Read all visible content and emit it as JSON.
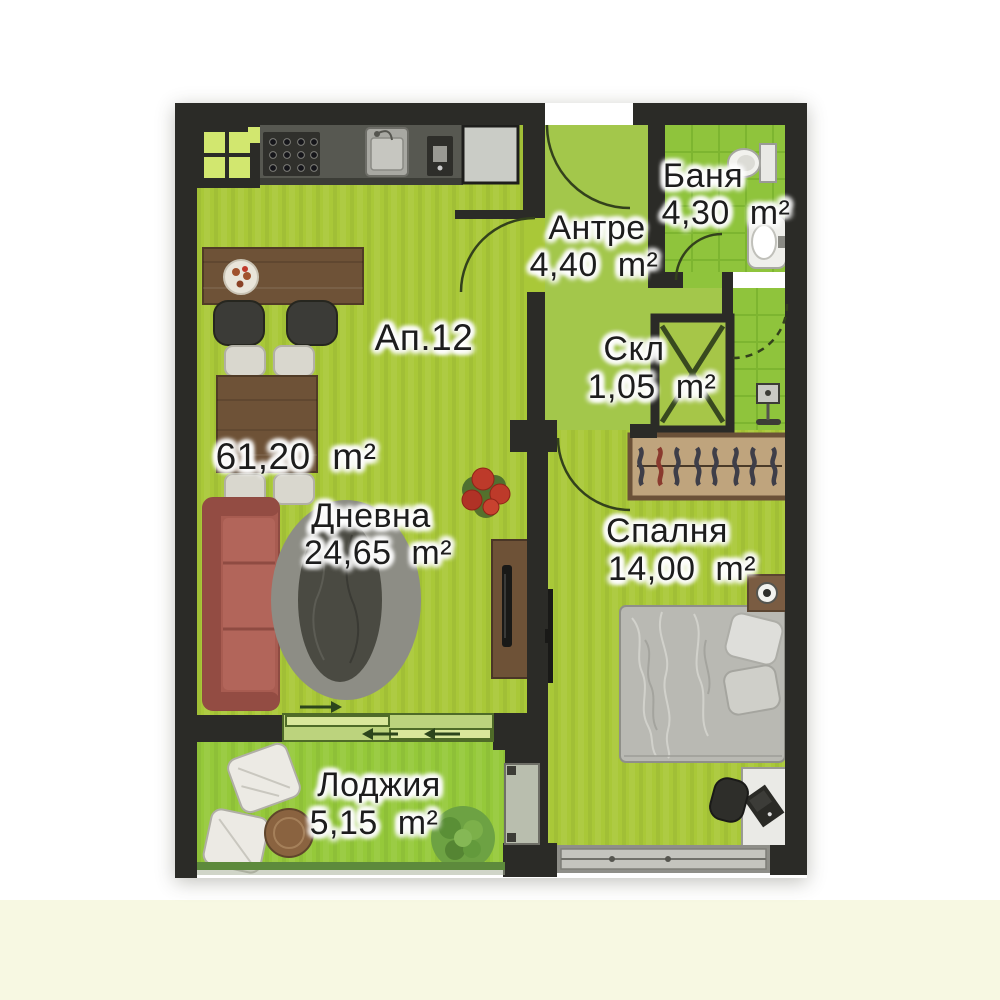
{
  "plan": {
    "apartment_label": "Ап.12",
    "total_area": "61,20  m²",
    "rooms": [
      {
        "id": "antre",
        "name": "Антре",
        "area": "4,40  m²"
      },
      {
        "id": "banya",
        "name": "Баня",
        "area": "4,30  m²"
      },
      {
        "id": "skl",
        "name": "Скл",
        "area": "1,05  m²"
      },
      {
        "id": "dnevna",
        "name": "Дневна",
        "area": "24,65  m²"
      },
      {
        "id": "spalnya",
        "name": "Спалня",
        "area": "14,00  m²"
      },
      {
        "id": "lodzhiya",
        "name": "Лоджия",
        "area": "5,15  m²"
      }
    ],
    "colors": {
      "wall": "#2b2b27",
      "floor_main": "#a9c838",
      "floor_hall": "#a3c74b",
      "floor_tile": "#8fc43c",
      "tile_grout": "#7ab32e",
      "floor_loggia": "#95c93a",
      "wood": "#6e5237",
      "sofa": "#a85c51",
      "label_text": "#1d1d1d",
      "background_bottom": "#f7f8e2"
    },
    "furniture_icons": [
      "corner-window",
      "kitchen-counter",
      "stove",
      "kitchen-sink",
      "coffee-machine",
      "refrigerator",
      "bar-counter",
      "serving-plate",
      "bar-stools",
      "dining-table",
      "dining-chairs",
      "sofa",
      "rug",
      "flower-plant",
      "tv-cabinet",
      "tv",
      "wall-tv",
      "wardrobe-with-hangers",
      "bed",
      "pillows",
      "nightstand",
      "table-lamp",
      "desk",
      "laptop",
      "desk-chair",
      "toilet",
      "bathroom-sink",
      "ventilation-shaft",
      "electric-panel",
      "balcony-chairs",
      "balcony-table",
      "bush",
      "sliding-door",
      "bedroom-window",
      "door-arc"
    ]
  }
}
